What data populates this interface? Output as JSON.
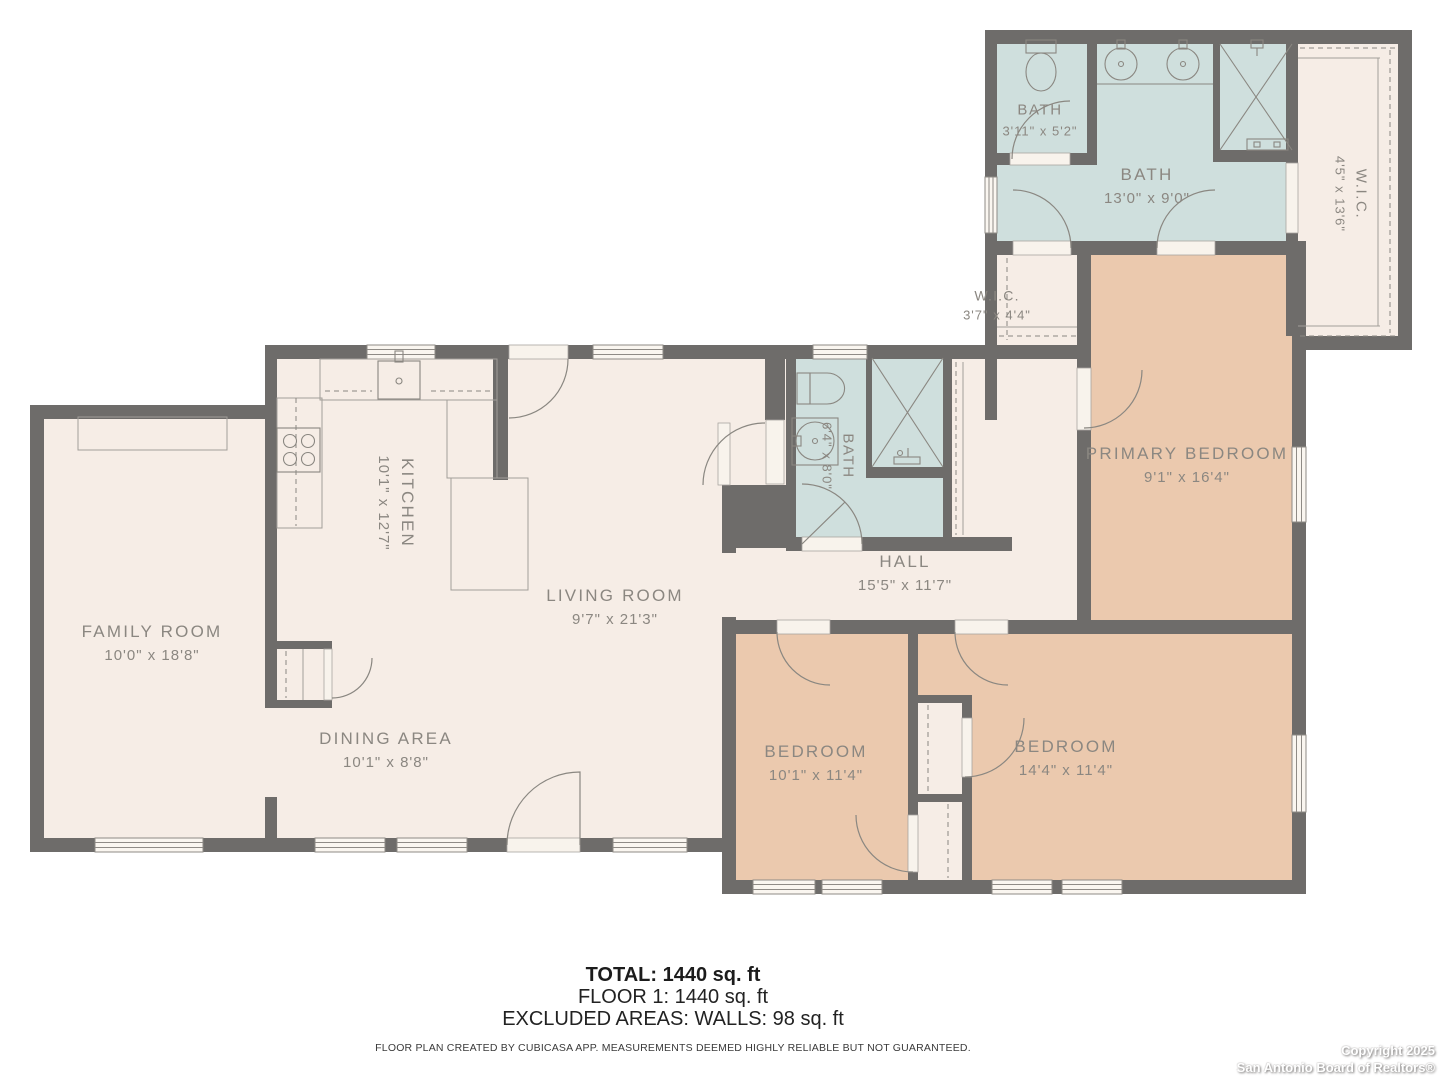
{
  "colors": {
    "wall": "#6e6c6a",
    "floor_cream": "#f6ede6",
    "bedroom_tan": "#ebc9ae",
    "bath_blue": "#cfdfdd",
    "label_text": "#8b8781",
    "background": "#ffffff"
  },
  "rooms": {
    "family_room": {
      "name": "FAMILY ROOM",
      "dims": "10'0\" x 18'8\""
    },
    "kitchen": {
      "name": "KITCHEN",
      "dims": "10'1\" x 12'7\""
    },
    "dining_area": {
      "name": "DINING AREA",
      "dims": "10'1\" x 8'8\""
    },
    "living_room": {
      "name": "LIVING ROOM",
      "dims": "9'7\" x 21'3\""
    },
    "hall": {
      "name": "HALL",
      "dims": "15'5\" x 11'7\""
    },
    "hall_bath": {
      "name": "BATH",
      "dims": "6'4\" x 8'0\""
    },
    "bedroom_left": {
      "name": "BEDROOM",
      "dims": "10'1\" x 11'4\""
    },
    "bedroom_right": {
      "name": "BEDROOM",
      "dims": "14'4\" x 11'4\""
    },
    "primary_bedroom": {
      "name": "PRIMARY BEDROOM",
      "dims": "9'1\" x 16'4\""
    },
    "bath_small": {
      "name": "BATH",
      "dims": "3'11\" x 5'2\""
    },
    "bath_primary": {
      "name": "BATH",
      "dims": "13'0\" x 9'0\""
    },
    "wic_large": {
      "name": "W.I.C.",
      "dims": "4'5\" x 13'6\""
    },
    "wic_small": {
      "name": "W.I.C.",
      "dims": "3'7\" x 4'4\""
    }
  },
  "summary": {
    "total": "TOTAL: 1440 sq. ft",
    "floor": "FLOOR 1: 1440 sq. ft",
    "excluded": "EXCLUDED AREAS: WALLS: 98 sq. ft",
    "disclaimer": "FLOOR PLAN CREATED BY CUBICASA APP. MEASUREMENTS DEEMED HIGHLY RELIABLE BUT NOT GUARANTEED."
  },
  "copyright": {
    "line1": "Copyright 2025",
    "line2": "San Antonio Board of Realtors®"
  }
}
